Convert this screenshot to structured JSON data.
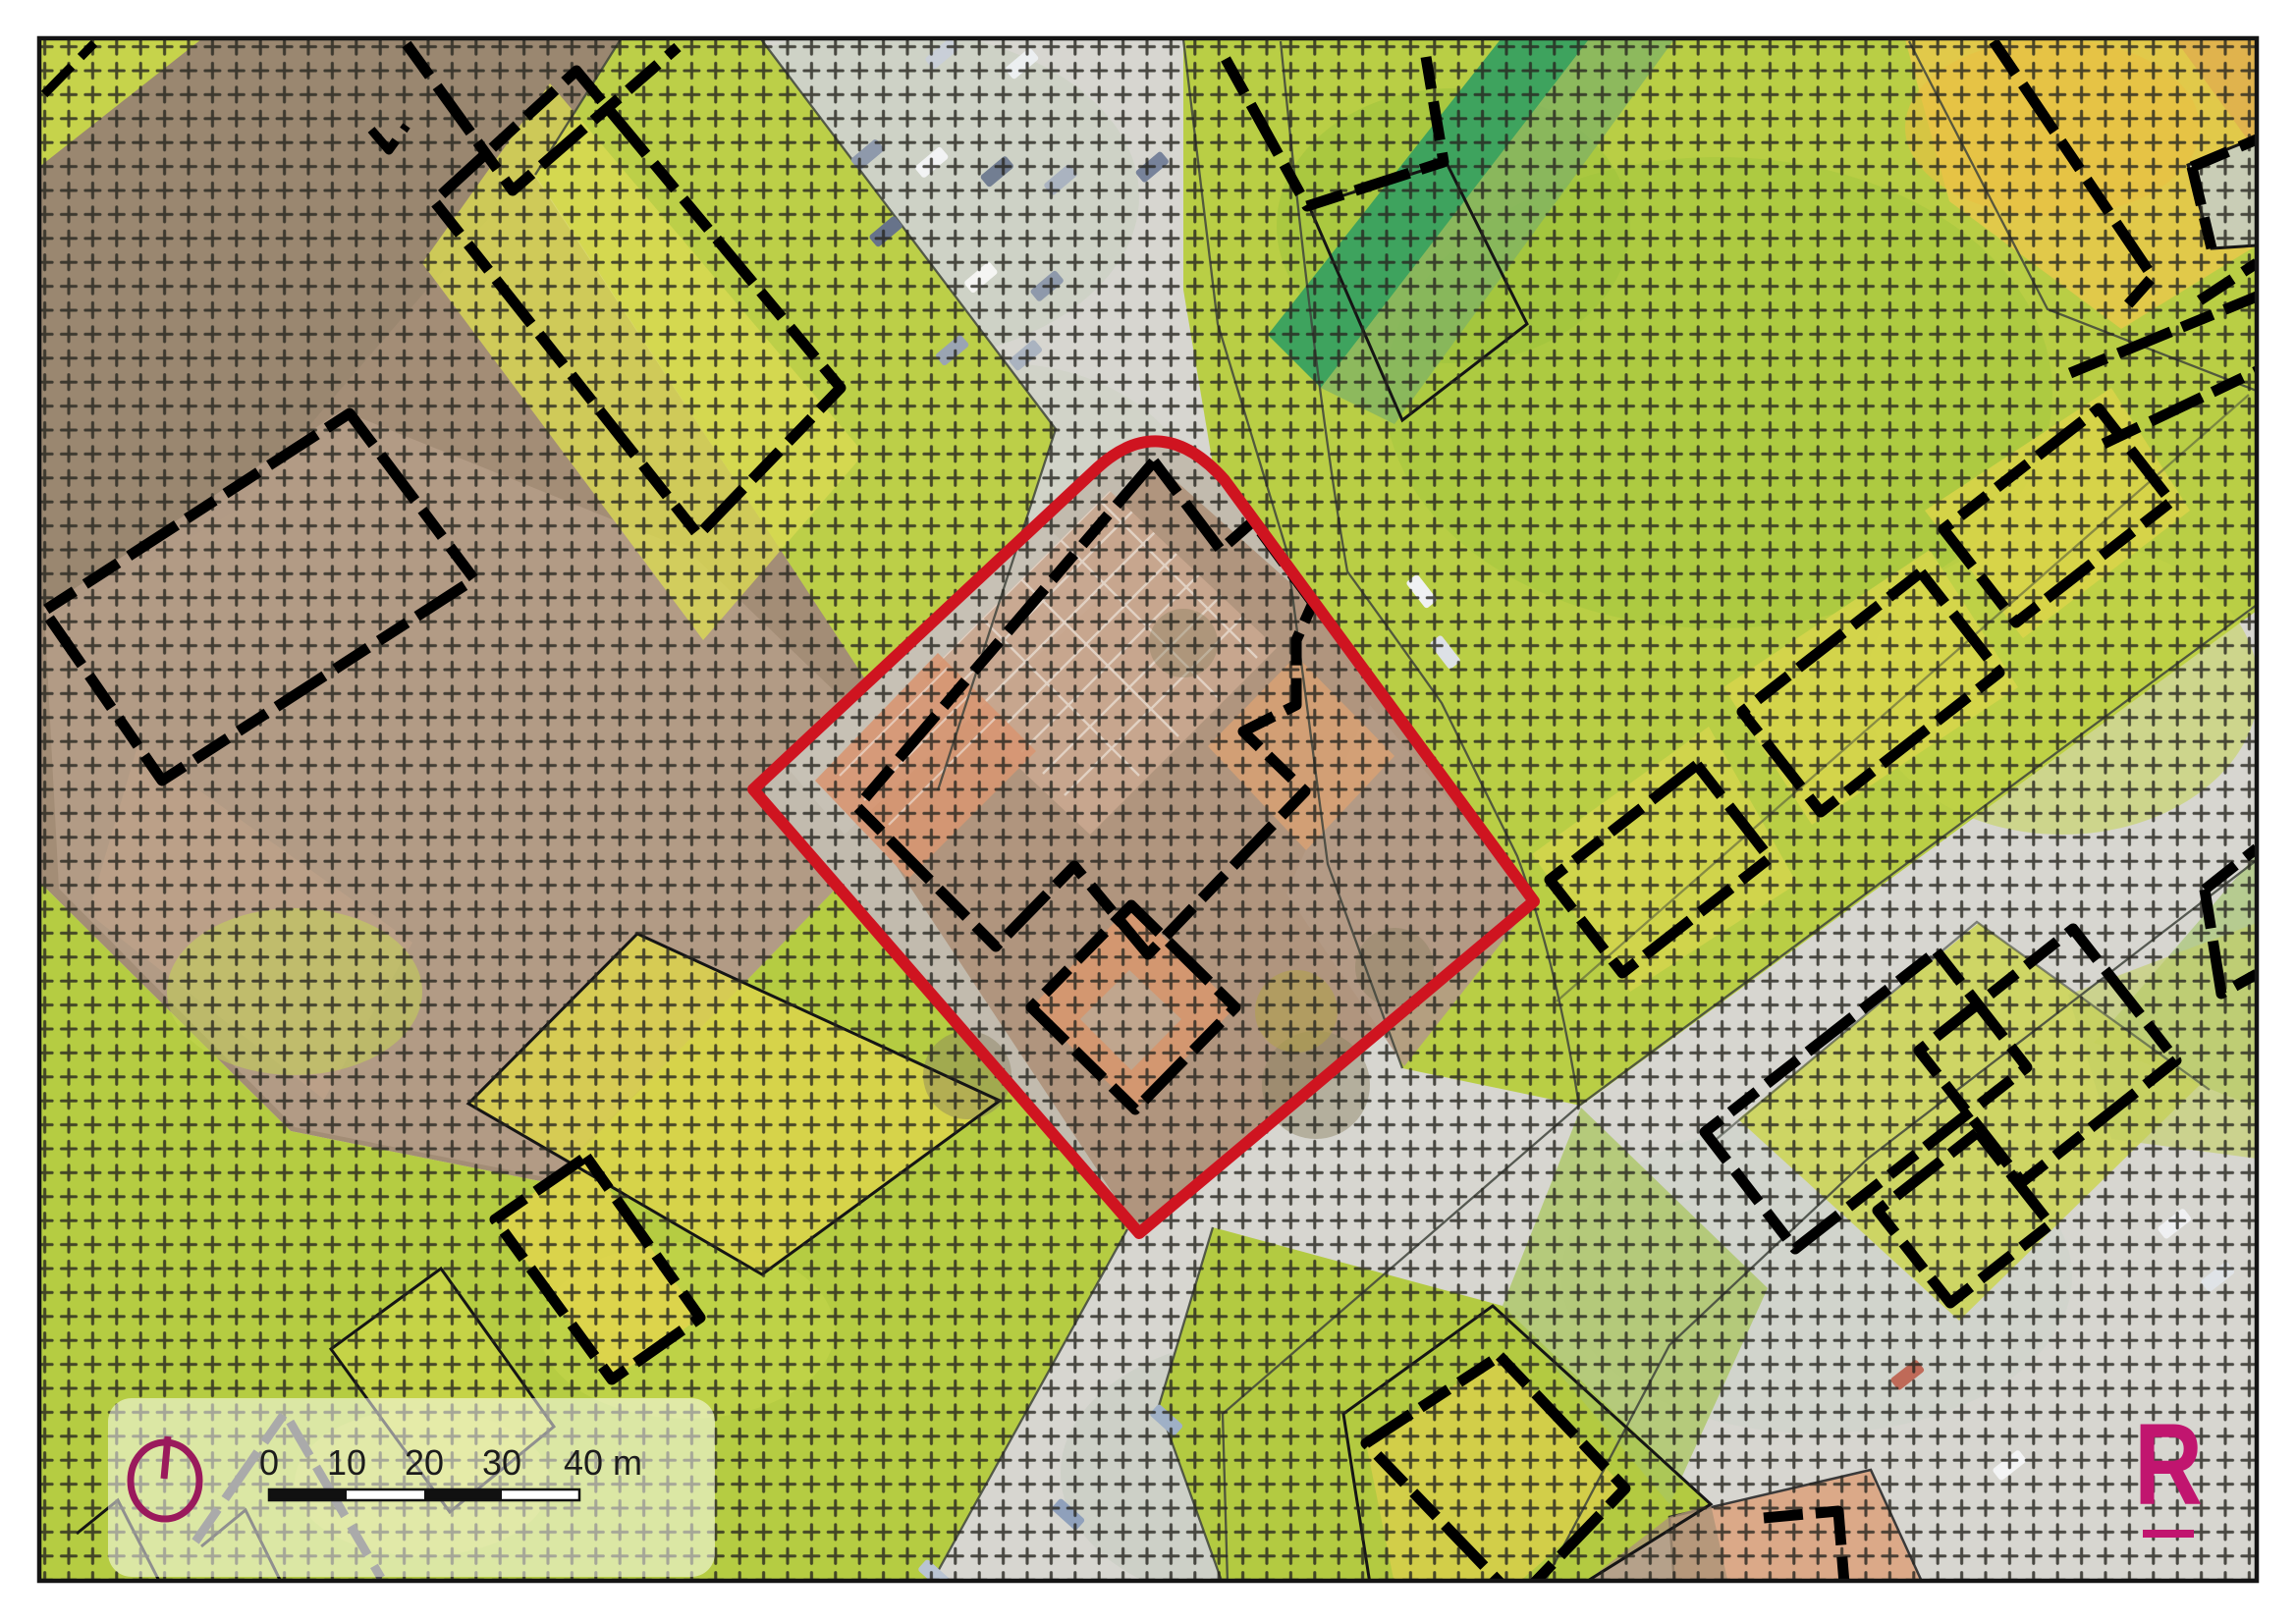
{
  "map": {
    "title": "cadastral site plan over aerial photo",
    "scale_bar": {
      "labels": [
        "0",
        "10",
        "20",
        "30",
        "40 m"
      ],
      "unit": "m"
    },
    "logo": {
      "letter": "R"
    },
    "colors": {
      "site_boundary_red": "#cf1420",
      "logo_magenta": "#c1156f",
      "north_magenta": "#9a1a5c",
      "building_outline": "#000000",
      "survey_grid_cross": "#26251f",
      "field_green": "#b7cd43",
      "parcel_yellow": "#ddd84e",
      "road_gray": "#d7d6d0",
      "bare_soil_brown": "#a8937c",
      "roof_salmon": "#d4906e",
      "dark_green_strip": "#3ea35e"
    }
  }
}
